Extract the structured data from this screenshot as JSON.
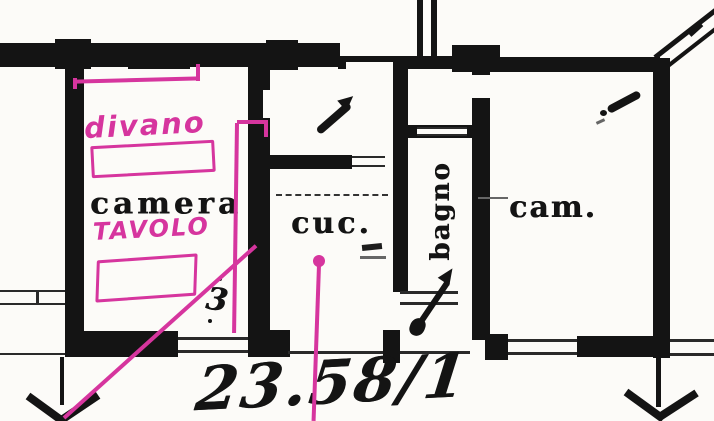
{
  "plan": {
    "rooms": {
      "camera": "camera",
      "cucina": "cuc.",
      "cam": "cam.",
      "bagno": "bagno"
    },
    "marker_notes": {
      "divano": "divano",
      "tavolo": "TAVOLO"
    },
    "handwritten": {
      "parcel_number": "23.58/1",
      "small_mark": "3"
    },
    "colors": {
      "ink": "#141414",
      "marker_pink": "#d6359e",
      "paper": "#fcfbf8"
    }
  }
}
